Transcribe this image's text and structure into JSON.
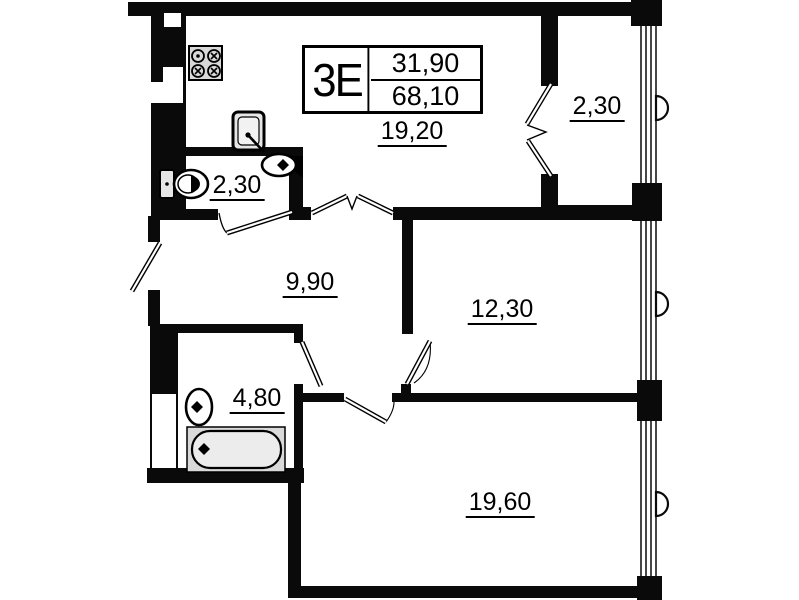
{
  "title_block": {
    "unit_type": "3Е",
    "living_area": "31,90",
    "total_area": "68,10"
  },
  "rooms": {
    "kitchen_living": {
      "area": "19,20"
    },
    "loggia": {
      "area": "2,30"
    },
    "wc": {
      "area": "2,30"
    },
    "hall": {
      "area": "9,90"
    },
    "bedroom_mid": {
      "area": "12,30"
    },
    "bathroom": {
      "area": "4,80"
    },
    "bedroom_big": {
      "area": "19,60"
    }
  },
  "colors": {
    "wall": "#0a0a0a",
    "background": "#ffffff",
    "fixture_fill": "#d9d9d9"
  }
}
